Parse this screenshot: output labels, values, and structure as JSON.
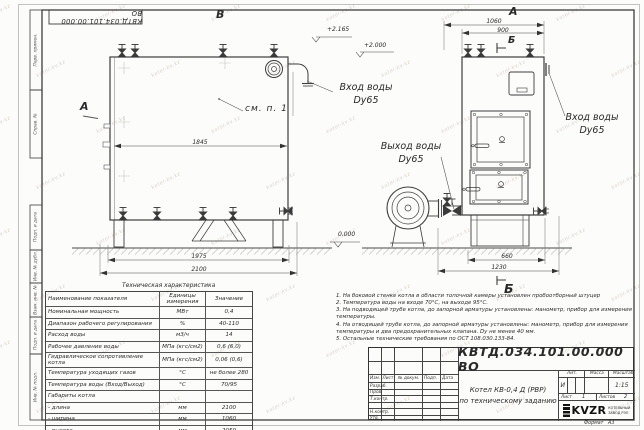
{
  "doc": {
    "code": "КВТД.034.101.00.000 ВО"
  },
  "frame": {
    "side_labels": [
      "Перв. примен.",
      "Справ. №",
      "Подп. и дата",
      "Инв. № дубл.",
      "Взам. инв. №",
      "Подп. и дата",
      "Инв. № подл."
    ]
  },
  "views": {
    "front": {
      "view_label": "В",
      "arrow_label": "А",
      "see_note": "см. п. 1",
      "dim_inner": "1845",
      "dim_base": "1975",
      "dim_total": "2100",
      "elev_top": "+2.165",
      "elev_mid": "+2.000",
      "elev_zero": "0.000",
      "inlet_line1": "Вход воды",
      "inlet_line2": "Dy65",
      "outlet_line1": "Выход воды",
      "outlet_line2": "Dy65"
    },
    "side": {
      "view_label": "А",
      "section_top": "Б",
      "section_bottom": "Б",
      "dim_top_outer": "1060",
      "dim_top_inner": "900",
      "dim_bottom_inner": "660",
      "dim_bottom_outer": "1230",
      "inlet_line1": "Вход воды",
      "inlet_line2": "Dy65"
    }
  },
  "tech_table": {
    "title": "Техническая характеристика",
    "headers": [
      "Наименование показателя",
      "Единицы измерения",
      "Значение"
    ],
    "rows": [
      [
        "Номинальная мощность",
        "МВт",
        "0,4"
      ],
      [
        "Диапазон рабочего регулирования",
        "%",
        "40-110"
      ],
      [
        "Расход воды",
        "м3/ч",
        "14"
      ],
      [
        "Рабочее давление воды",
        "МПа (кгс/см2)",
        "0,6 (6,0)"
      ],
      [
        "Гидравлическое сопротивление котла",
        "МПа (кгс/см2)",
        "0,06 (0,6)"
      ],
      [
        "Температура уходящих газов",
        "°С",
        "не более 280"
      ],
      [
        "Температура воды (Вход/Выход)",
        "°С",
        "70/95"
      ],
      [
        "Габариты котла",
        "",
        ""
      ],
      [
        "- длина",
        "мм",
        "2100"
      ],
      [
        "- ширина",
        "мм",
        "1060"
      ],
      [
        "- высота",
        "мм",
        "2050"
      ]
    ]
  },
  "notes": [
    "1.  На боковой стенке котла в области топочной камеры установлен пробоотборный штуцер",
    "2.  Температура воды на входе 70°С, на выходе 95°С.",
    "3.  На подводящей трубе котла, до запорной арматуры установлены: манометр, прибор для измерения температуры.",
    "4.  На отводящей трубе котла, до запорной арматуры установлены: манометр, прибор для измерения температуры и два предохранительных клапана. Dу не менее 40 мм.",
    "5.  Остальные технические требования по ОСТ 108.030.133-84."
  ],
  "title_block": {
    "code": "КВТД.034.101.00.000 ВО",
    "product_line1": "Котел КВ-0,4 Д (РВР)",
    "product_line2": "по техническому заданию",
    "cols_headers": [
      "Изм.",
      "Лист",
      "№ докум.",
      "Подп.",
      "Дата"
    ],
    "roles": [
      "Разраб.",
      "Пров.",
      "Т.контр.",
      "",
      "Н.контр.",
      "Утв."
    ],
    "lit_label": "Лит.",
    "lit_value": "И",
    "mass_label": "Масса",
    "scale_label": "Масштаб",
    "scale_value": "1:15",
    "sheet_label": "Лист",
    "sheet_value": "1",
    "sheets_label": "Листов",
    "sheets_value": "2",
    "logo_text": "KVZR",
    "company_line1": "КОТЕЛЬНЫЙ",
    "company_line2": "ЗАВОД РЭП",
    "format_label": "Формат",
    "format_value": "А3"
  },
  "watermark": {
    "text": "kotel-kv.kz"
  }
}
